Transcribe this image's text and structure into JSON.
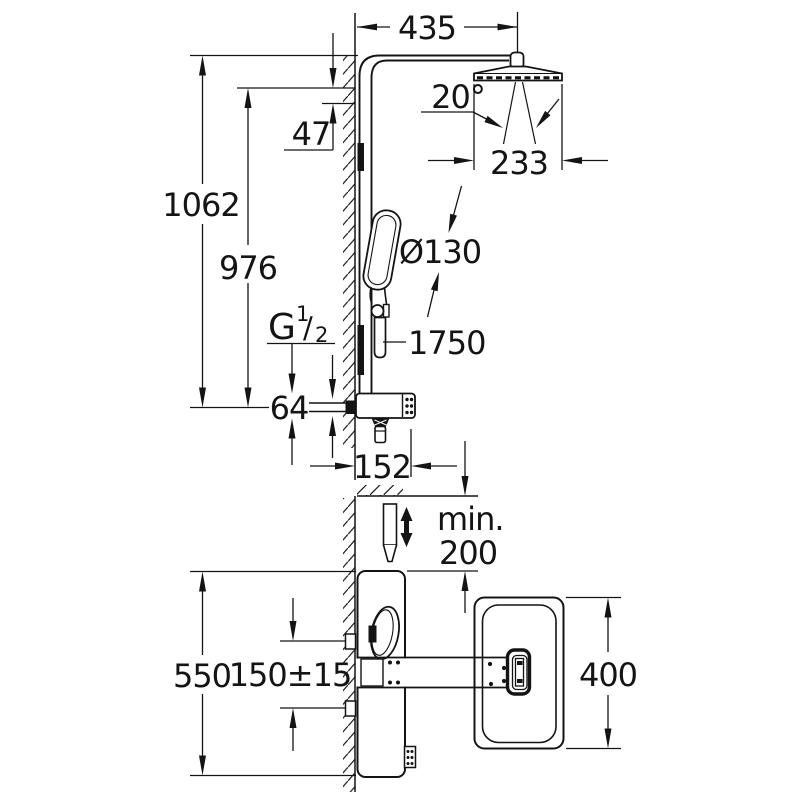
{
  "page": {
    "background": "#ffffff",
    "line_color": "#141414",
    "drawing_type": "shower-system-installation-dimensions"
  },
  "labels": {
    "top_width": "435",
    "spray_angle": "20°",
    "head_width": "233",
    "head_drop": "47",
    "total_height": "1062",
    "arm_height": "976",
    "handshower_diameter": "Ø130",
    "hose_length": "1750",
    "thread_g": "G",
    "thread_numerator": "1",
    "thread_slash": "/",
    "thread_denominator": "2",
    "inlet_offset": "64",
    "body_depth": "152",
    "min_label": "min.",
    "min_value": "200",
    "panel_height": "550",
    "inlet_spacing": "150±15",
    "plate_height": "400"
  }
}
